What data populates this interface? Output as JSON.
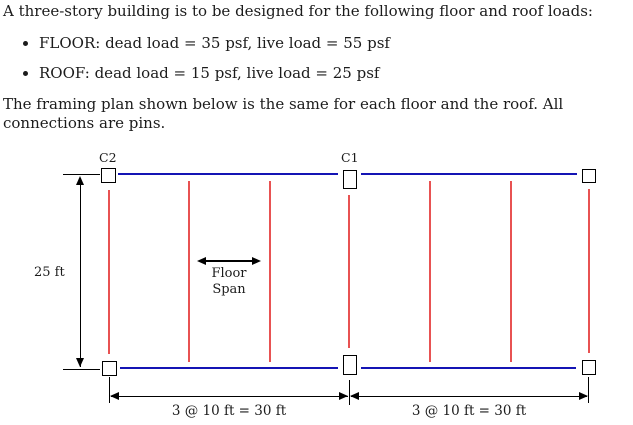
{
  "problem": {
    "intro": "A three-story building is to be designed for the following floor and roof loads:",
    "bullets": [
      "FLOOR: dead load = 35 psf, live load = 55 psf",
      "ROOF: dead load = 15 psf, live load = 25 psf"
    ],
    "note": "The framing plan shown below is the same for each floor and the roof. All connections are pins."
  },
  "diagram": {
    "labels": {
      "column_c2": "C2",
      "column_c1": "C1",
      "height_dim": "25 ft",
      "floor_span_line1": "Floor",
      "floor_span_line2": "Span",
      "bay_left_dim": "3 @ 10 ft = 30 ft",
      "bay_right_dim": "3 @ 10 ft = 30 ft"
    },
    "colors": {
      "girder": "#1414b4",
      "joist": "#e85252",
      "line": "#000000"
    }
  }
}
